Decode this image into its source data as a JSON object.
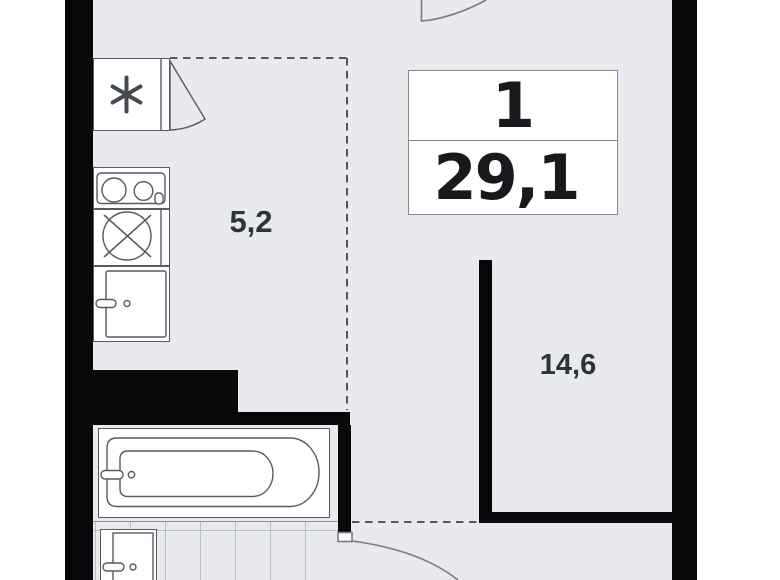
{
  "title": "apartment floor plan",
  "unit": {
    "rooms_label": "1",
    "area_label": "29,1"
  },
  "zones": {
    "kitchen_area": "5,2",
    "living_area": "14,6"
  },
  "fixtures": [
    "fridge",
    "stove",
    "sink",
    "sink-cabinet",
    "bathtub",
    "washbasin"
  ],
  "colors": {
    "wall": "#070809",
    "floor": "#e8eaed",
    "outside": "#ffffff",
    "fixture_line": "#565b61",
    "dash_line": "#41464b",
    "tile_line": "#b8bfc7",
    "door_line": "#787d82",
    "info_border": "#85898d",
    "text_dark": "#17191c",
    "text_label": "#2e3338"
  }
}
